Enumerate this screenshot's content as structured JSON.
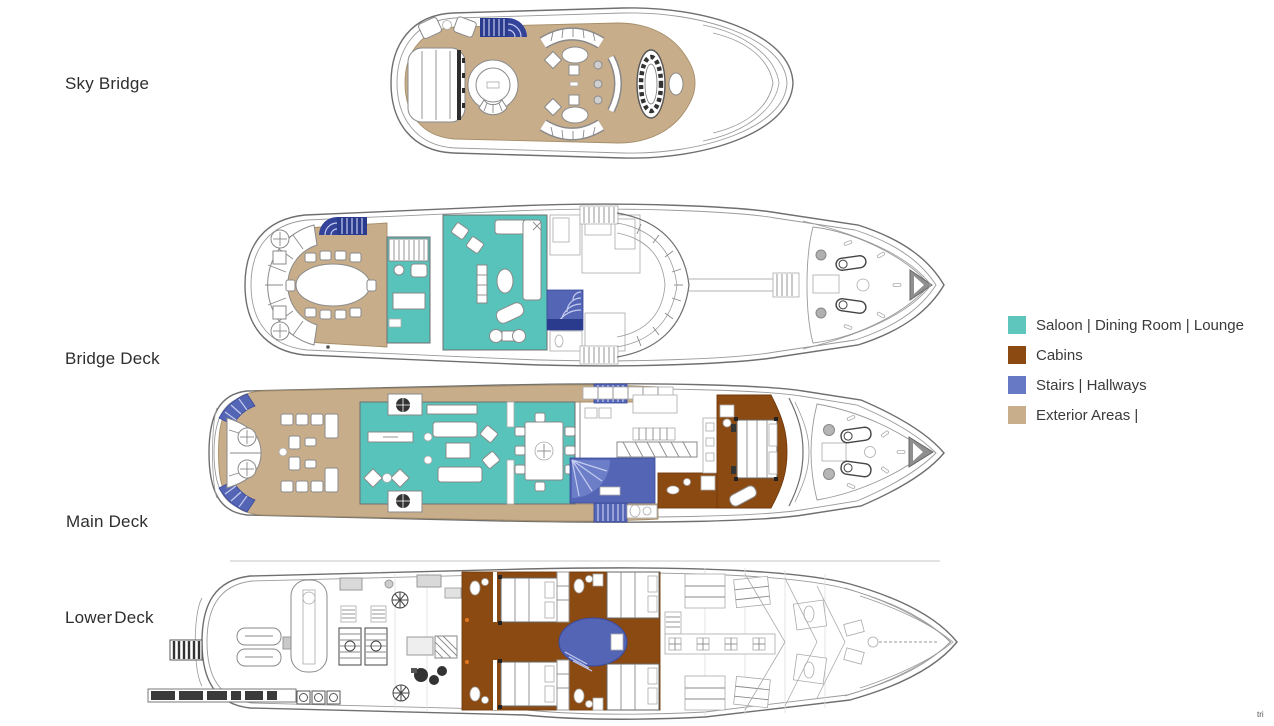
{
  "decks": [
    {
      "id": "sky-bridge",
      "label": "Sky Bridge"
    },
    {
      "id": "bridge-deck",
      "label": "Bridge Deck"
    },
    {
      "id": "main-deck",
      "label": "Main Deck"
    },
    {
      "id": "lower-deck",
      "label": "Lower Deck"
    }
  ],
  "legend": {
    "items": [
      {
        "name": "saloon-dining-lounge",
        "label": "Saloon | Dining Room | Lounge",
        "color": "#5ec6bd"
      },
      {
        "name": "cabins",
        "label": "Cabins",
        "color": "#8a4a12"
      },
      {
        "name": "stairs-hallways",
        "label": "Stairs | Hallways",
        "color": "#6779c5"
      },
      {
        "name": "exterior-areas",
        "label": "Exterior Areas |",
        "color": "#c9ae8b"
      }
    ]
  },
  "colors": {
    "background": "#ffffff",
    "saloon": "#57c3ba",
    "cabins": "#8c4a13",
    "stairs": "#5565b5",
    "stairs_dark": "#2a3a8c",
    "exterior": "#c8ad8a",
    "hull_outline": "#6f6f6f",
    "label_text": "#2e2e2e"
  },
  "corner_mark": "tri"
}
